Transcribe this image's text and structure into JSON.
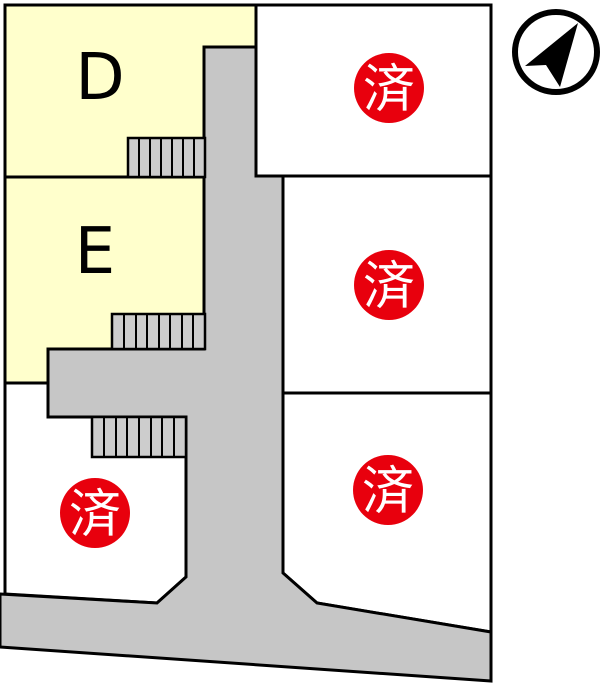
{
  "map": {
    "type": "residential-lot-layout",
    "sold_mark": "済",
    "lots": [
      {
        "id": "D",
        "label": "D",
        "status": "available",
        "mark": ""
      },
      {
        "id": "E",
        "label": "E",
        "status": "available",
        "mark": ""
      },
      {
        "id": "northeast",
        "label": "",
        "status": "sold",
        "mark": "済"
      },
      {
        "id": "east",
        "label": "",
        "status": "sold",
        "mark": "済"
      },
      {
        "id": "southeast",
        "label": "",
        "status": "sold",
        "mark": "済"
      },
      {
        "id": "southwest",
        "label": "",
        "status": "sold",
        "mark": "済"
      }
    ],
    "colors": {
      "available_fill": "#ffffcc",
      "vacant_fill": "#ffffff",
      "road_fill": "#c6c6c6",
      "stairs_fill": "#cdcdcd",
      "outline": "#000000",
      "sold_badge_fill": "#e8000d",
      "sold_badge_text": "#ffffff",
      "label_text": "#000000",
      "compass_color": "#000000"
    },
    "compass": {
      "type": "north-arrow"
    }
  }
}
